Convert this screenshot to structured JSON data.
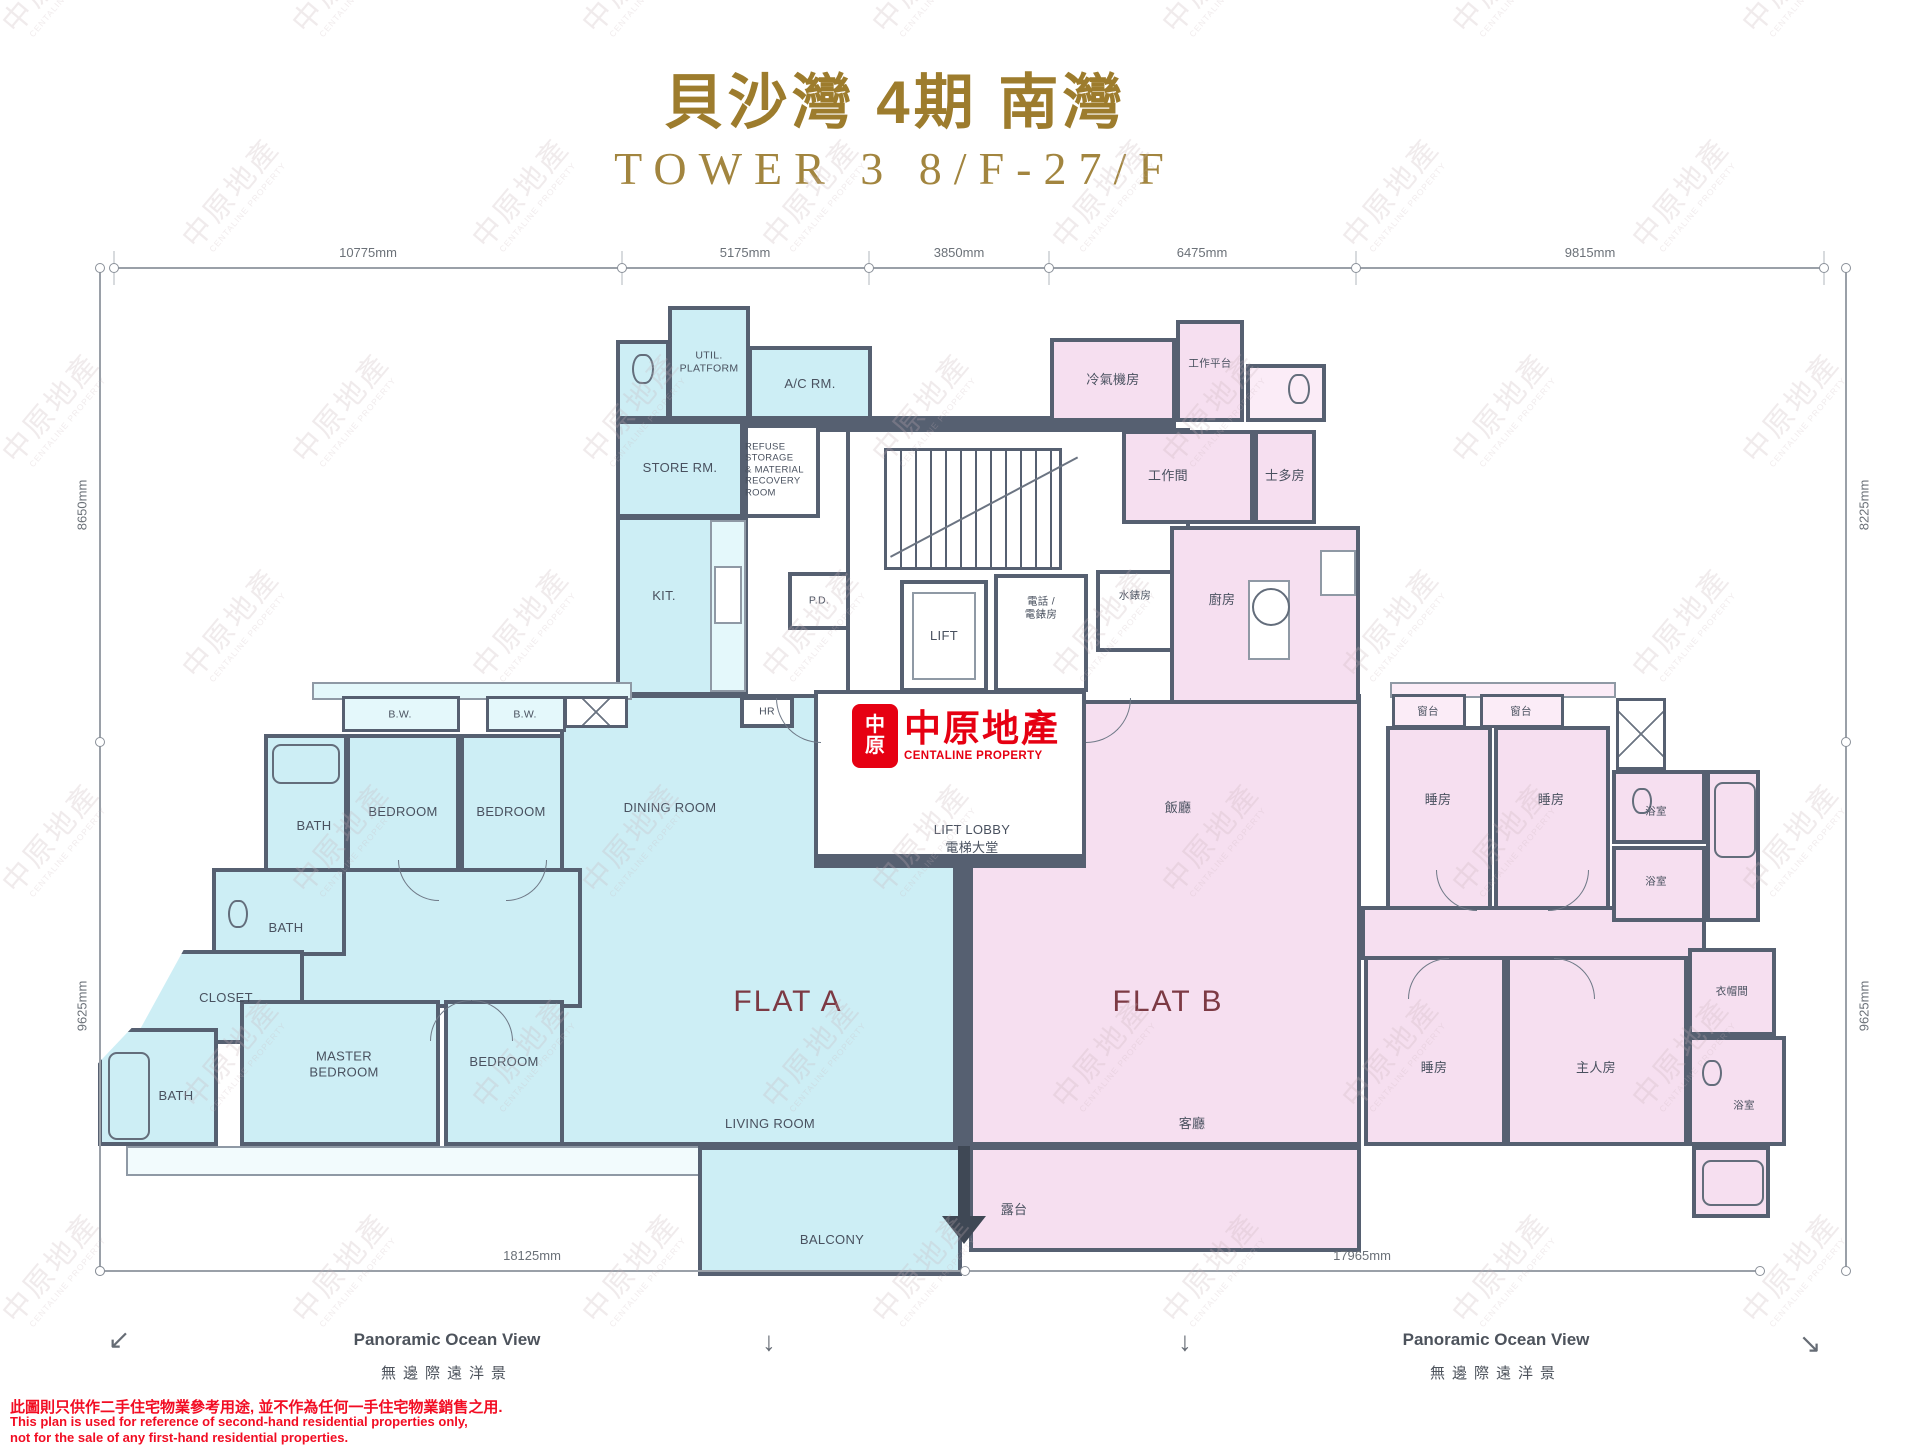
{
  "title": {
    "main": "貝沙灣 4期 南灣",
    "sub": "TOWER 3   8/F-27/F"
  },
  "dimensions": {
    "top": [
      "10775mm",
      "5175mm",
      "3850mm",
      "6475mm",
      "9815mm"
    ],
    "left": [
      "8650mm",
      "9625mm"
    ],
    "right": [
      "8225mm",
      "9625mm"
    ],
    "bottom": [
      "18125mm",
      "17965mm"
    ]
  },
  "flats": {
    "a": "FLAT A",
    "b": "FLAT B"
  },
  "rooms": {
    "util_platform": "UTIL.\nPLATFORM",
    "ac_rm": "A/C RM.",
    "store_rm": "STORE RM.",
    "refuse": "REFUSE STORAGE\n& MATERIAL\nRECOVERY\nROOM",
    "kit": "KIT.",
    "pd": "P.D.",
    "hr": "HR",
    "lift": "LIFT",
    "tel_meter": "電話 /\n電錶房",
    "water_meter": "水錶房",
    "lift_lobby_en": "LIFT LOBBY",
    "lift_lobby_zh": "電梯大堂",
    "bw": "B.W.",
    "bath": "BATH",
    "bedroom": "BEDROOM",
    "dining_room": "DINING ROOM",
    "living_room": "LIVING ROOM",
    "master_bedroom": "MASTER\nBEDROOM",
    "closet": "CLOSET",
    "balcony": "BALCONY",
    "ac_plant_zh": "冷氣機房",
    "work_platform_zh": "工作平台",
    "workroom_zh": "工作間",
    "storeroom_zh": "士多房",
    "kitchen_zh": "廚房",
    "dining_zh": "飯廳",
    "living_zh": "客廳",
    "bedroom_zh": "睡房",
    "master_zh": "主人房",
    "cloak_zh": "衣帽間",
    "bathroom_zh": "浴室",
    "bay_zh": "窗台",
    "balcony_zh": "露台"
  },
  "logo": {
    "emblem_top": "中",
    "emblem_bottom": "原",
    "name_zh": "中原地產",
    "name_en": "CENTALINE PROPERTY"
  },
  "footer": {
    "ocean_view_en": "Panoramic Ocean View",
    "ocean_view_zh": "無邊際遠洋景",
    "disclaimer_zh": "此圖則只供作二手住宅物業參考用途, 並不作為任何一手住宅物業銷售之用.",
    "disclaimer_en1": "This plan is used for reference of second-hand residential properties only,",
    "disclaimer_en2": "not for the sale of any first-hand residential properties."
  },
  "watermark": {
    "zh": "中原地產",
    "en": "CENTALINE PROPERTY"
  },
  "colors": {
    "flat_a": "#cdeef5",
    "flat_b": "#f6dff0",
    "wall": "#566071",
    "accent_red": "#e60012",
    "title_gold": "#9d7c2d"
  }
}
